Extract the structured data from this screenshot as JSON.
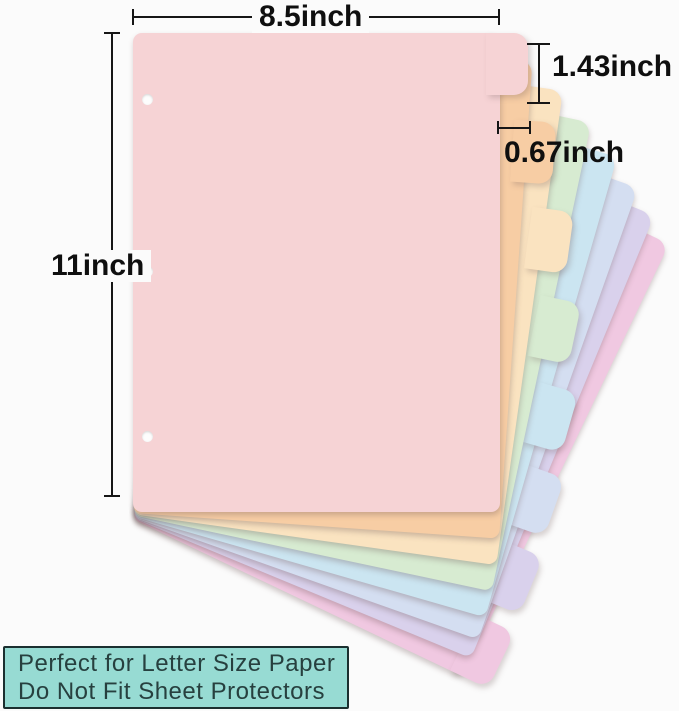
{
  "annotations": {
    "width_label": "8.5inch",
    "height_label": "11inch",
    "tab_height_label": "1.43inch",
    "tab_width_label": "0.67inch",
    "line_color": "#161616"
  },
  "footer": {
    "line1": "Perfect for Letter Size Paper",
    "line2": "Do Not Fit Sheet Protectors",
    "background": "#97dbd3",
    "border_color": "#1b2f2f",
    "text_color": "#27403f"
  },
  "sheets": [
    {
      "name": "pink",
      "color": "#f6d3d5"
    },
    {
      "name": "peach",
      "color": "#f7cda4"
    },
    {
      "name": "cream",
      "color": "#fae3c0"
    },
    {
      "name": "mint",
      "color": "#d7ebd1"
    },
    {
      "name": "blue",
      "color": "#cbe5f1"
    },
    {
      "name": "periwinkle",
      "color": "#d4def1"
    },
    {
      "name": "lavender",
      "color": "#d9d1ec"
    },
    {
      "name": "magenta",
      "color": "#f0c8e1"
    }
  ]
}
